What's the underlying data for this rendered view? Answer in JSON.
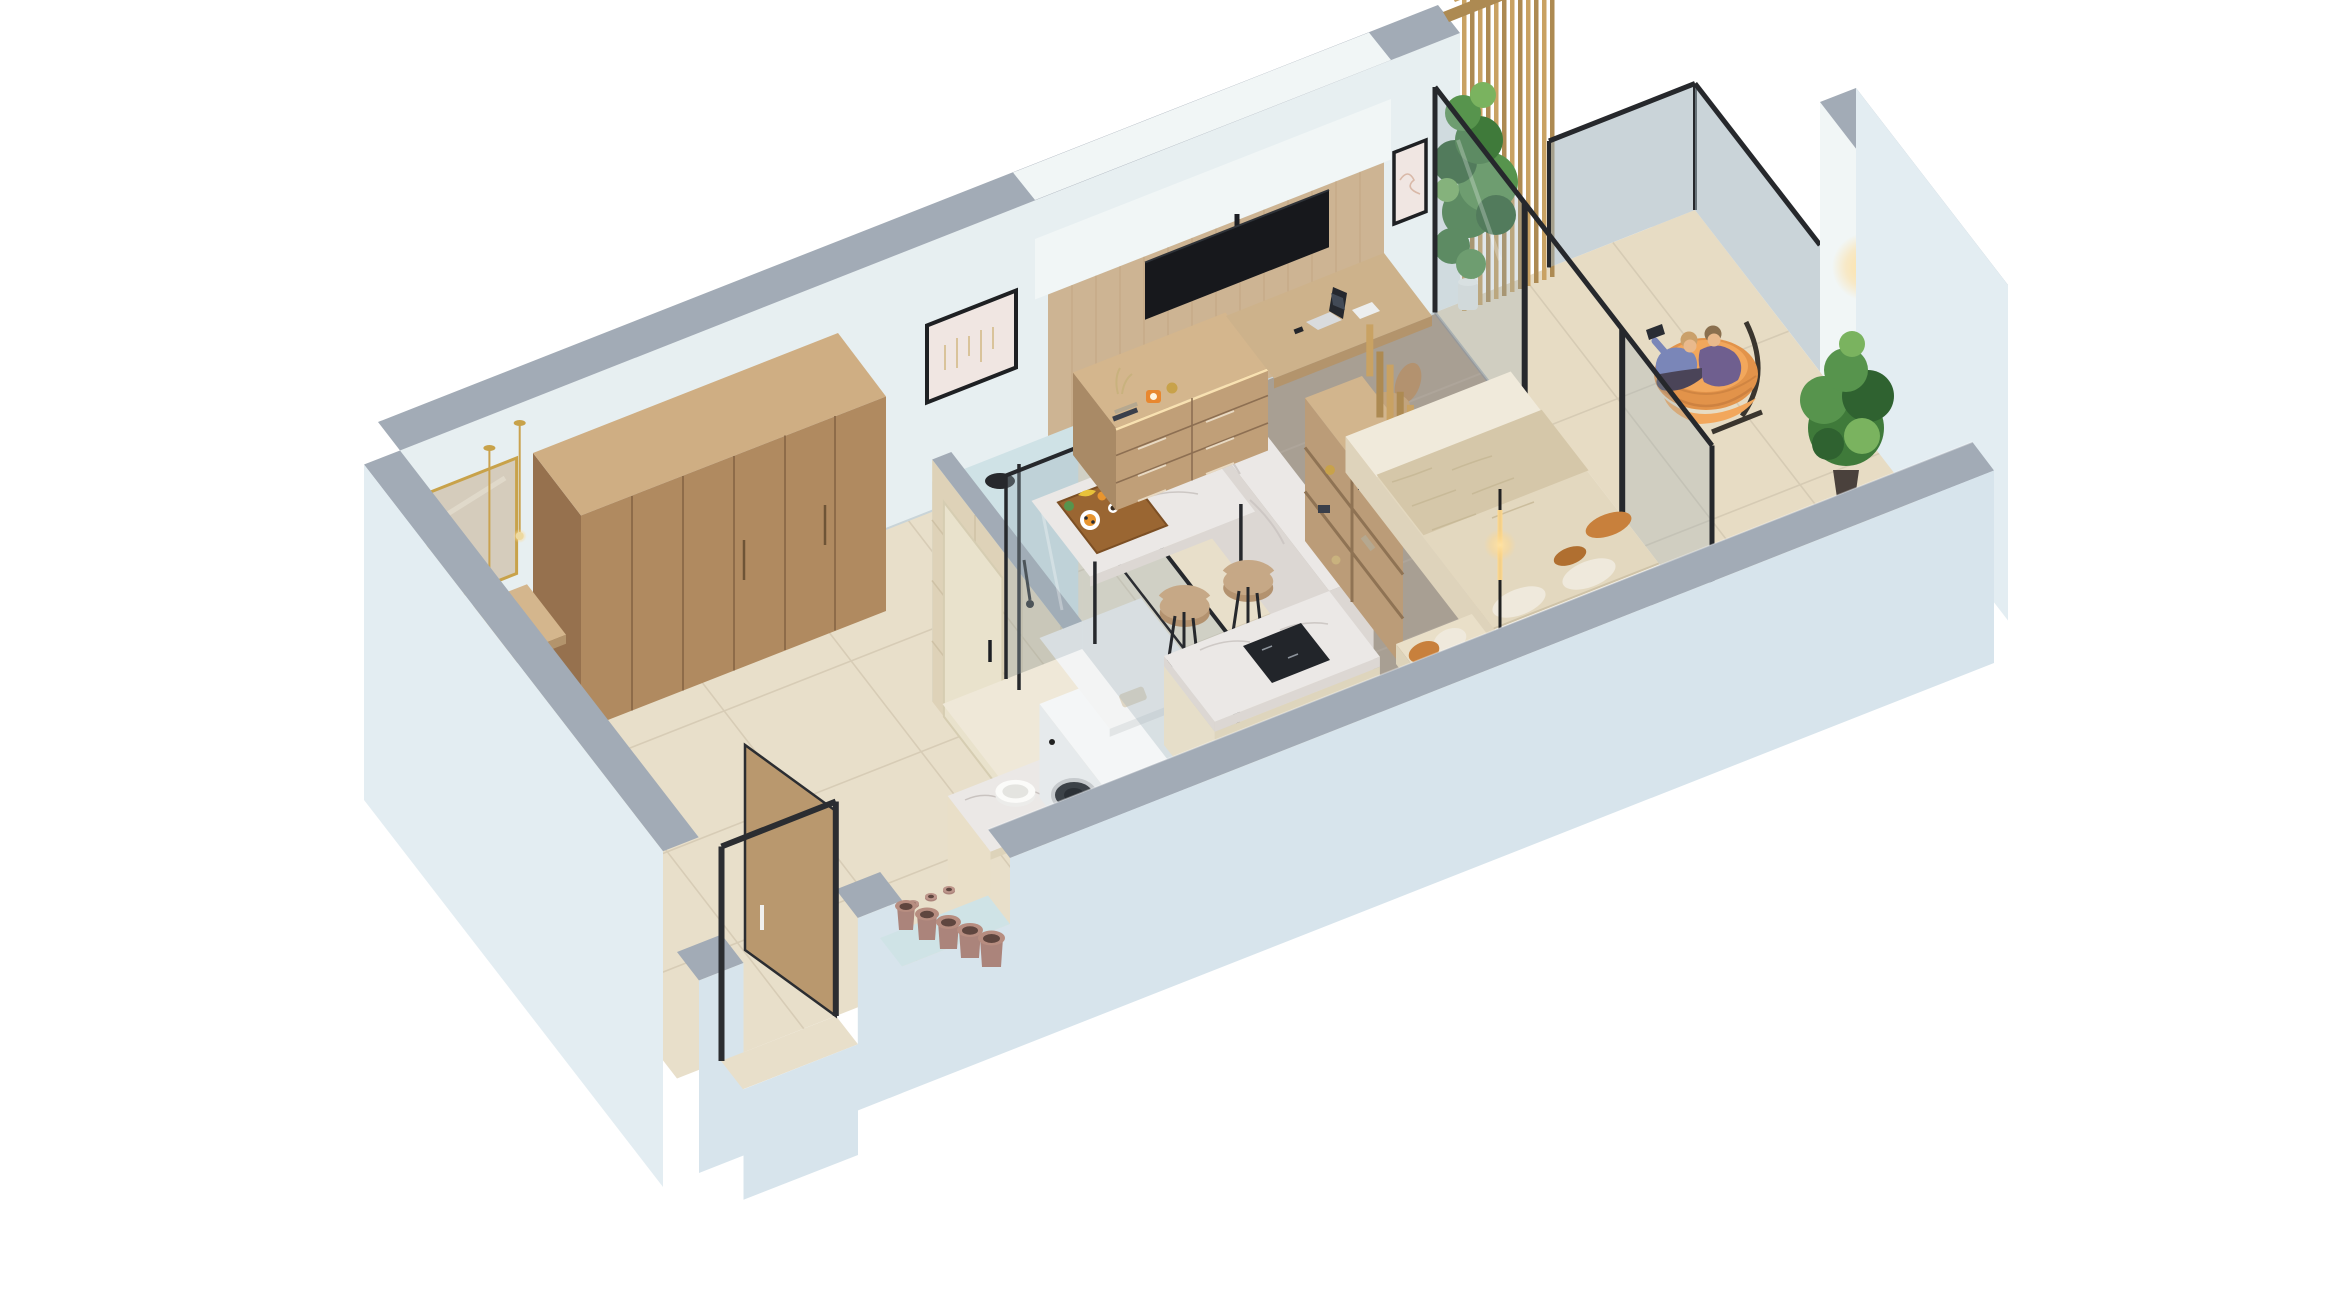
{
  "page": {
    "title": "3D isometric cutaway floor plan of a studio apartment",
    "background": "#ffffff"
  },
  "palette": {
    "bg": "#ffffff",
    "capGrey": "#a2abb6",
    "capGreyDark": "#8b95a1",
    "wallInner": "#e7eff1",
    "wallInnerShade": "#d3dfe3",
    "wallOuter": "#d7e4ec",
    "wallOuterLight": "#e3edf2",
    "soffit": "#f1f6f6",
    "tileFloor": "#e8dfca",
    "tileLine": "#d6cbb4",
    "balconyTile": "#e7dcc4",
    "rug": "#a89f93",
    "marbleTop": "#ebe8e6",
    "marbleSide": "#dcd7d3",
    "marbleVein": "#c9c3c0",
    "woodWardrobe": "#b08a60",
    "woodWardrobeTop": "#cfae83",
    "woodWardrobeSide": "#96714e",
    "woodPanel": "#cdb493",
    "woodPanelLine": "#bfa27e",
    "woodDesk": "#cdb28b",
    "woodDeskEdge": "#b3946c",
    "woodDresser": "#c09f78",
    "woodDresserTop": "#d4b68d",
    "woodDresserSide": "#a98a66",
    "woodShelf": "#bb9c78",
    "woodShelfTop": "#d2b58d",
    "woodShelfLine": "#8f7354",
    "slat": "#c9a263",
    "slatDark": "#ad8a52",
    "glass": "#9fb0ba",
    "frameDark": "#26282c",
    "tv": "#17181c",
    "black": "#1d1f24",
    "white": "#f4f6f7",
    "washerFront": "#e6eaec",
    "drum": "#3c4248",
    "accentBlue": "#cfe2e6",
    "bathTile": "#ded2b8",
    "cream": "#e9dfc8",
    "creamDark": "#ddd3ba",
    "bedSheet": "#f0eadb",
    "duvet": "#e3d8bf",
    "duvetTexture": "#d5c7a9",
    "pillowWhite": "#efe9dc",
    "pillowOrange": "#c8803c",
    "chairTan": "#c2a47e",
    "stoolTan": "#c6a886",
    "stoolTanDark": "#b3926f",
    "gold": "#c8a24a",
    "glow": "#ffd98e",
    "ledWarm": "#ffe9b8",
    "terracotta": "#ab847b",
    "terracottaDark": "#5f463f",
    "trough": "#cfe3e6",
    "plantDark": "#2f6230",
    "plant": "#3f7a3a",
    "plantLight": "#57944d",
    "plantLighter": "#7ab35f",
    "orangeChair": "#e2934a",
    "orangeChairLight": "#f2a75c",
    "blanketStripe": "#c97f3f",
    "personBlue": "#7a86b8",
    "personPurple": "#6f5f8f",
    "personDark": "#4a4458",
    "skin": "#e9b98c",
    "hairBlond": "#caa06a",
    "hairBrown": "#8a6f4e",
    "doorWood": "#b9986e",
    "artBlush": "#f0e6e2",
    "artLine": "#d9b9a8",
    "trayWood": "#9a6632",
    "foodOrange": "#e8952f"
  },
  "scene": {
    "view": "isometric-cutaway-dollhouse",
    "unit": "studio-apartment-with-balcony",
    "rooms": [
      {
        "name": "entry-hall"
      },
      {
        "name": "bathroom-laundry"
      },
      {
        "name": "kitchen-dining"
      },
      {
        "name": "living-sleeping-area"
      },
      {
        "name": "balcony"
      }
    ],
    "objects": [
      "entry-console",
      "gold-framed-mirror",
      "brass-pendant-lights",
      "glowing-candles",
      "entry-door",
      "wardrobe",
      "terracotta-pot-niche",
      "vanity-vessel-sink",
      "bathroom-door",
      "washing-machine",
      "laundry-shelf",
      "walk-in-shower",
      "black-shower-set",
      "marble-dining-counter",
      "breakfast-tray",
      "bar-stools",
      "kitchen-island",
      "induction-cooktop",
      "tv-media-wall",
      "wall-mounted-tv",
      "dresser",
      "built-in-desk",
      "laptop",
      "office-chair",
      "framed-art-left",
      "framed-art-right",
      "bed",
      "headboard-shelving",
      "wood-slat-partition",
      "foot-bench",
      "floor-lamp",
      "sliding-glass-door",
      "wood-slat-feature-wall",
      "climbing-plant",
      "balcony-plant",
      "hanging-egg-chair",
      "two-people-with-tablet",
      "wall-sconce",
      "glass-balustrade"
    ],
    "people_count": 2
  }
}
